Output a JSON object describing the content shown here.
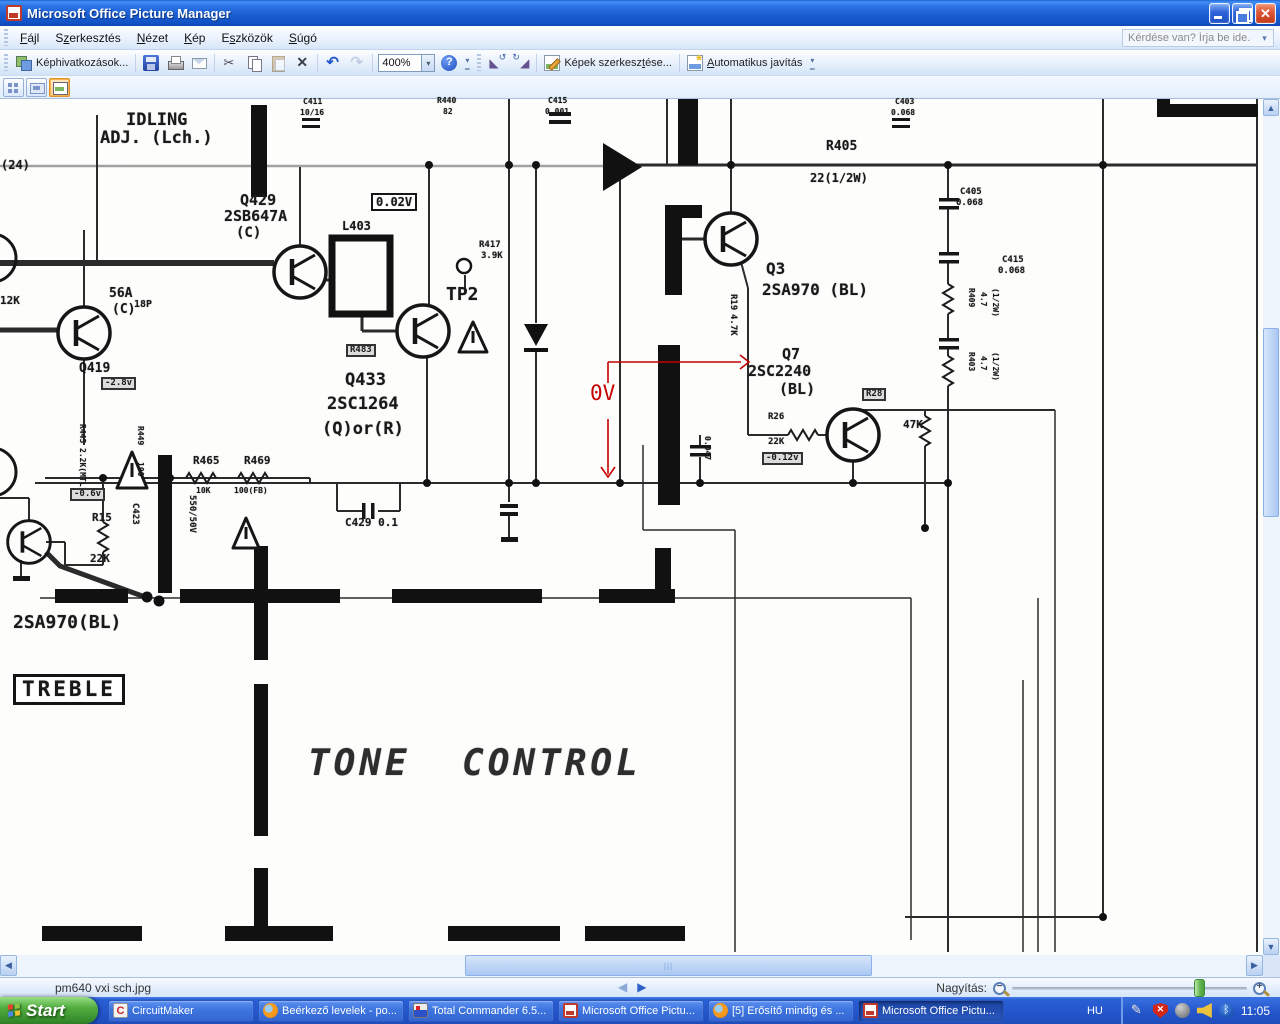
{
  "window": {
    "title": "Microsoft Office Picture Manager"
  },
  "menubar": {
    "items": [
      {
        "label": "Fájl",
        "accel": 0
      },
      {
        "label": "Szerkesztés",
        "accel": 1
      },
      {
        "label": "Nézet",
        "accel": 0
      },
      {
        "label": "Kép",
        "accel": 0
      },
      {
        "label": "Eszközök",
        "accel": 1
      },
      {
        "label": "Súgó",
        "accel": 0
      }
    ],
    "help_placeholder": "Kérdése van? Írja be ide."
  },
  "toolbar": {
    "shortcuts_label": "Képhivatkozások...",
    "zoom_value": "400%",
    "edit_pictures": {
      "pre": "Képek szerkesz",
      "u": "t",
      "post": "ése..."
    },
    "autocorrect": {
      "pre": "",
      "u": "A",
      "post": "utomatikus javítás"
    }
  },
  "statusbar": {
    "filename": "pm640 vxi sch.jpg",
    "zoom_label": "Nagyítás:"
  },
  "taskbar": {
    "start_label": "Start",
    "language": "HU",
    "time": "11:05",
    "tasks": [
      {
        "label": "CircuitMaker",
        "icon": "circuitmaker",
        "active": false
      },
      {
        "label": "Beérkező levelek - po...",
        "icon": "firefox",
        "active": false
      },
      {
        "label": "Total Commander 6.5...",
        "icon": "tc",
        "active": false
      },
      {
        "label": "Microsoft Office Pictu...",
        "icon": "mopm",
        "active": false
      },
      {
        "label": "[5] Erősítő mindig és ...",
        "icon": "firefox",
        "active": false
      },
      {
        "label": "Microsoft Office Pictu...",
        "icon": "mopm",
        "active": true
      }
    ],
    "tray_icons": [
      "pen-icon",
      "security-shield-icon",
      "status-icon",
      "volume-icon",
      "bluetooth-icon"
    ]
  },
  "schematic": {
    "labels": [
      {
        "t": "IDLING",
        "x": 126,
        "y": 112,
        "f": 17
      },
      {
        "t": "ADJ. (Lch.)",
        "x": 100,
        "y": 130,
        "f": 17
      },
      {
        "t": "Q429",
        "x": 240,
        "y": 193,
        "f": 15
      },
      {
        "t": "2SB647A",
        "x": 224,
        "y": 209,
        "f": 15
      },
      {
        "t": "(C)",
        "x": 236,
        "y": 226,
        "f": 14
      },
      {
        "t": "L403",
        "x": 342,
        "y": 220,
        "f": 12
      },
      {
        "t": "0.02V",
        "x": 371,
        "y": 193,
        "f": 12,
        "c": "box"
      },
      {
        "t": "R417",
        "x": 479,
        "y": 241,
        "f": 9
      },
      {
        "t": "3.9K",
        "x": 481,
        "y": 252,
        "f": 9
      },
      {
        "t": "TP2",
        "x": 446,
        "y": 286,
        "f": 18
      },
      {
        "t": "Q433",
        "x": 345,
        "y": 372,
        "f": 17
      },
      {
        "t": "2SC1264",
        "x": 327,
        "y": 396,
        "f": 17
      },
      {
        "t": "(Q)or(R)",
        "x": 322,
        "y": 421,
        "f": 17
      },
      {
        "t": "C429 0.1",
        "x": 345,
        "y": 517,
        "f": 11
      },
      {
        "t": "Q3",
        "x": 766,
        "y": 261,
        "f": 16
      },
      {
        "t": "2SA970 (BL)",
        "x": 762,
        "y": 282,
        "f": 16
      },
      {
        "t": "Q7",
        "x": 782,
        "y": 347,
        "f": 15
      },
      {
        "t": "2SC2240",
        "x": 748,
        "y": 364,
        "f": 15
      },
      {
        "t": "(BL)",
        "x": 779,
        "y": 382,
        "f": 15
      },
      {
        "t": "R26",
        "x": 768,
        "y": 413,
        "f": 9
      },
      {
        "t": "22K",
        "x": 768,
        "y": 438,
        "f": 9
      },
      {
        "t": "-0.12v",
        "x": 762,
        "y": 452,
        "f": 9,
        "c": "boxdark"
      },
      {
        "t": "R28",
        "x": 862,
        "y": 388,
        "f": 9,
        "c": "boxdark"
      },
      {
        "t": "47K",
        "x": 903,
        "y": 419,
        "f": 11
      },
      {
        "t": "R405",
        "x": 826,
        "y": 140,
        "f": 13
      },
      {
        "t": "22(1/2W)",
        "x": 810,
        "y": 172,
        "f": 12
      },
      {
        "t": "R19",
        "x": 737,
        "y": 294,
        "f": 9,
        "r": 1
      },
      {
        "t": "4.7K",
        "x": 737,
        "y": 314,
        "f": 9,
        "r": 1
      },
      {
        "t": "C405",
        "x": 960,
        "y": 188,
        "f": 9
      },
      {
        "t": "0.068",
        "x": 956,
        "y": 199,
        "f": 9
      },
      {
        "t": "C415",
        "x": 1002,
        "y": 256,
        "f": 9
      },
      {
        "t": "0.068",
        "x": 998,
        "y": 267,
        "f": 9
      },
      {
        "t": "R409",
        "x": 975,
        "y": 288,
        "f": 8,
        "r": 1
      },
      {
        "t": "4.7",
        "x": 987,
        "y": 292,
        "f": 8,
        "r": 1
      },
      {
        "t": "(1/2W)",
        "x": 999,
        "y": 288,
        "f": 8,
        "r": 1
      },
      {
        "t": "R403",
        "x": 975,
        "y": 352,
        "f": 8,
        "r": 1
      },
      {
        "t": "4.7",
        "x": 987,
        "y": 356,
        "f": 8,
        "r": 1
      },
      {
        "t": "(1/2W)",
        "x": 999,
        "y": 352,
        "f": 8,
        "r": 1
      },
      {
        "t": "R465",
        "x": 193,
        "y": 455,
        "f": 11
      },
      {
        "t": "R469",
        "x": 244,
        "y": 455,
        "f": 11
      },
      {
        "t": "10K",
        "x": 196,
        "y": 487,
        "f": 8
      },
      {
        "t": "100(FB)",
        "x": 234,
        "y": 487,
        "f": 8
      },
      {
        "t": "R15",
        "x": 92,
        "y": 512,
        "f": 11
      },
      {
        "t": "22K",
        "x": 90,
        "y": 553,
        "f": 11
      },
      {
        "t": "C423",
        "x": 139,
        "y": 503,
        "f": 9,
        "r": 1
      },
      {
        "t": "550/50V",
        "x": 196,
        "y": 495,
        "f": 9,
        "r": 1
      },
      {
        "t": "2SA970(BL)",
        "x": 13,
        "y": 614,
        "f": 18
      },
      {
        "t": "TREBLE",
        "x": 13,
        "y": 674,
        "f": 21,
        "c": "box treble"
      },
      {
        "t": "TONE  CONTROL",
        "x": 308,
        "y": 746,
        "f": 36,
        "c": "tone"
      },
      {
        "t": "0V",
        "x": 590,
        "y": 383,
        "f": 21,
        "c": "red"
      },
      {
        "t": "(24)",
        "x": 1,
        "y": 159,
        "f": 12
      },
      {
        "t": "12K",
        "x": 0,
        "y": 295,
        "f": 11
      },
      {
        "t": "56A",
        "x": 109,
        "y": 287,
        "f": 13
      },
      {
        "t": "(C)",
        "x": 112,
        "y": 303,
        "f": 13
      },
      {
        "t": "18P",
        "x": 134,
        "y": 300,
        "f": 10
      },
      {
        "t": "Q419",
        "x": 79,
        "y": 362,
        "f": 13
      },
      {
        "t": "-2.8v",
        "x": 101,
        "y": 377,
        "f": 9,
        "c": "boxdark"
      },
      {
        "t": "R445",
        "x": 86,
        "y": 424,
        "f": 8,
        "r": 1
      },
      {
        "t": "2.2K(MTL)6B",
        "x": 86,
        "y": 448,
        "f": 8,
        "r": 1
      },
      {
        "t": "R449",
        "x": 144,
        "y": 426,
        "f": 8,
        "r": 1
      },
      {
        "t": "100",
        "x": 144,
        "y": 462,
        "f": 8,
        "r": 1
      },
      {
        "t": "-0.6v",
        "x": 70,
        "y": 488,
        "f": 9,
        "c": "boxdark"
      },
      {
        "t": "R483",
        "x": 346,
        "y": 344,
        "f": 9,
        "c": "boxdark"
      },
      {
        "t": "C411",
        "x": 303,
        "y": 98,
        "f": 8
      },
      {
        "t": "10/16",
        "x": 300,
        "y": 109,
        "f": 8
      },
      {
        "t": "R440",
        "x": 437,
        "y": 97,
        "f": 8
      },
      {
        "t": "82",
        "x": 443,
        "y": 108,
        "f": 8
      },
      {
        "t": "C415",
        "x": 548,
        "y": 97,
        "f": 8
      },
      {
        "t": "0.001",
        "x": 545,
        "y": 108,
        "f": 8
      },
      {
        "t": "C403",
        "x": 895,
        "y": 98,
        "f": 8
      },
      {
        "t": "0.068",
        "x": 891,
        "y": 109,
        "f": 8
      },
      {
        "t": "0.047",
        "x": 711,
        "y": 436,
        "f": 8,
        "r": 1
      }
    ]
  }
}
